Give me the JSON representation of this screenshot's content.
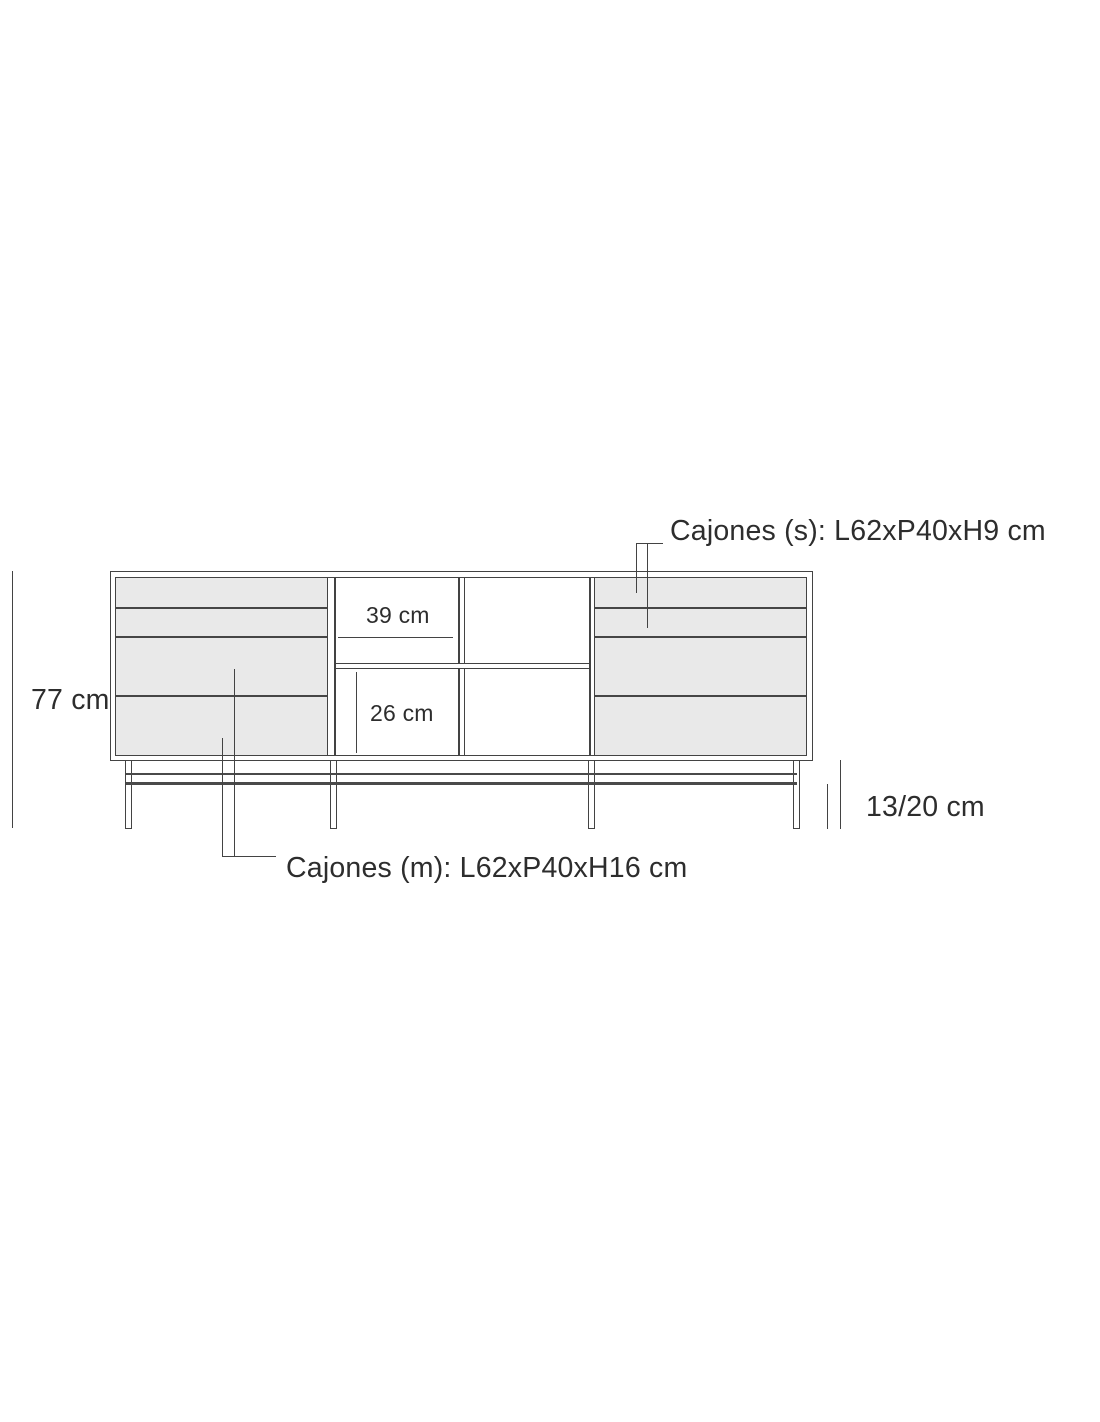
{
  "figure": {
    "labels": {
      "total_height": "77 cm",
      "niche_width": "39 cm",
      "niche_height": "26 cm",
      "base_clearance": "13/20 cm",
      "small_drawers": "Cajones (s): L62xP40xH9 cm",
      "medium_drawers": "Cajones (m): L62xP40xH16 cm"
    },
    "colors": {
      "line": "#434343",
      "text": "#2d2d2d",
      "drawer_fill": "#e9e9e9",
      "background": "#ffffff"
    }
  }
}
